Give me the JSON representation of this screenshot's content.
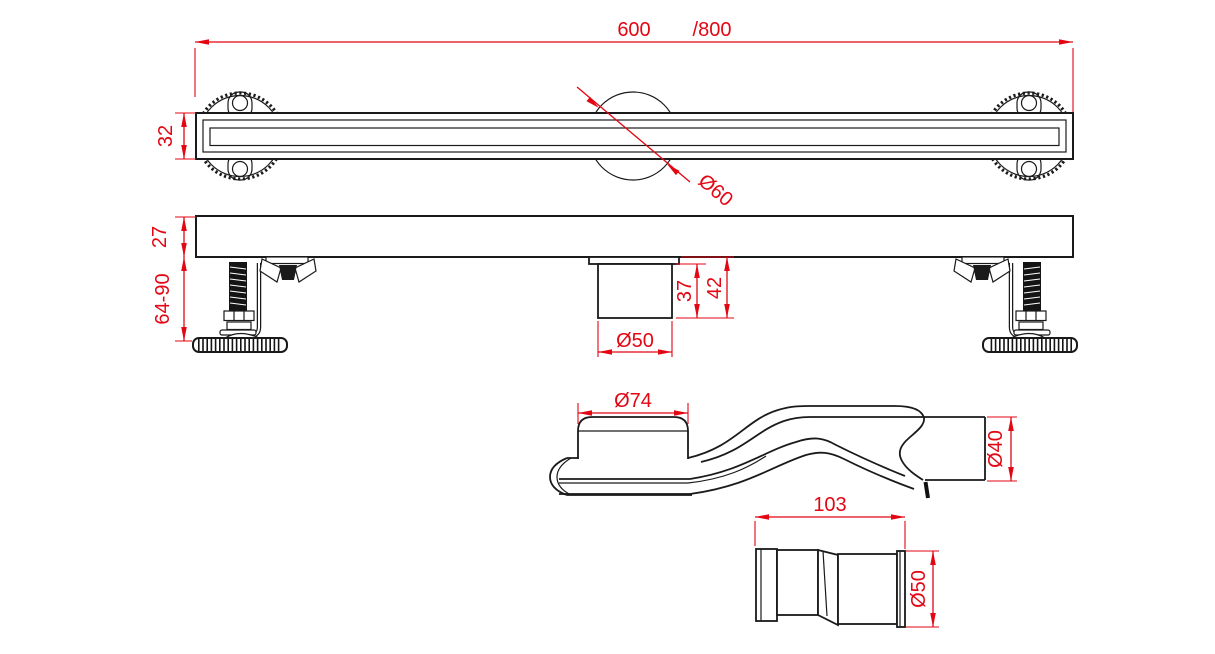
{
  "drawing": {
    "colors": {
      "dimension": "#e30613",
      "outline": "#1a1a1a",
      "background": "#ffffff"
    },
    "views": {
      "top": {
        "dims": {
          "length": "600",
          "length_alt": "/800",
          "channel_width": "32",
          "flange_diameter": "Ø60"
        }
      },
      "front": {
        "dims": {
          "body_height": "27",
          "leg_height_range": "64-90",
          "outlet_height": "37",
          "outlet_height_total": "42",
          "outlet_diameter": "Ø50"
        }
      },
      "siphon": {
        "dims": {
          "inlet_diameter": "Ø74",
          "outlet_diameter": "Ø40"
        }
      },
      "adapter": {
        "dims": {
          "length": "103",
          "diameter": "Ø50"
        }
      }
    }
  }
}
